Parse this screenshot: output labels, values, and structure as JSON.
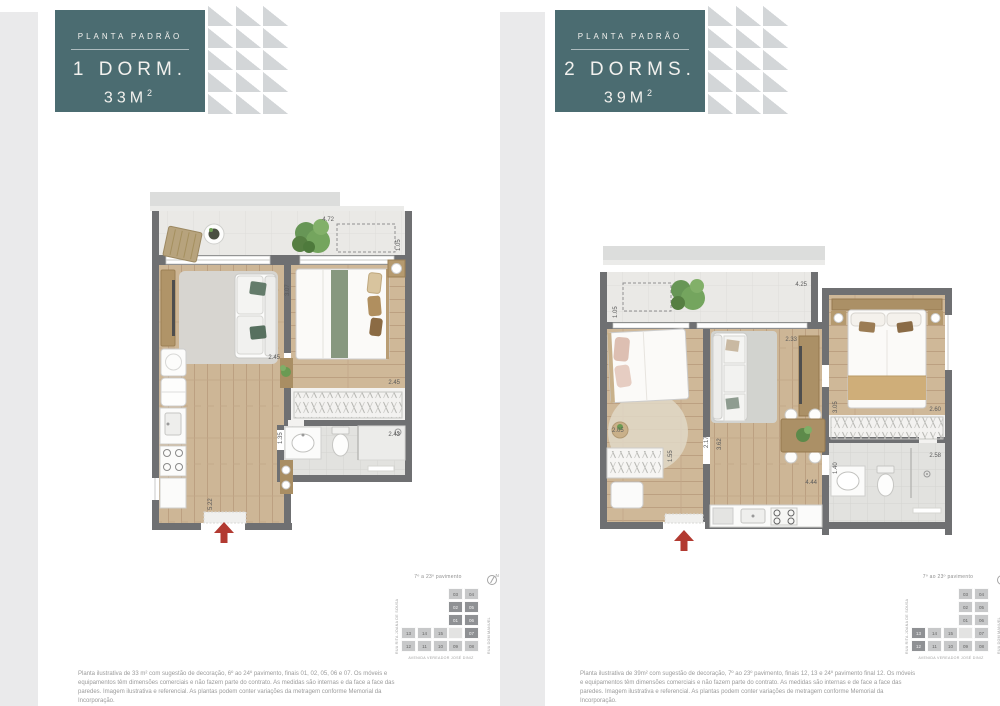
{
  "colors": {
    "accent_teal": "#4b6c71",
    "wall": "#6f7072",
    "entry_arrow": "#b23a31",
    "triangle": "#d3d6d8"
  },
  "panels": [
    {
      "badge": {
        "eyebrow": "PLANTA PADRÃO",
        "title": "1 DORM.",
        "area": "33M",
        "area_sup": "2"
      },
      "plan": {
        "dims": {
          "balcony_width": "4.72",
          "balcony_depth": "1.05",
          "bedroom_depth": "3.07",
          "living_width": "2.45",
          "closet_width": "2.45",
          "hall_width": "1.35",
          "bath_width": "2.43",
          "living_depth": "5.22"
        }
      },
      "keyplan": {
        "floors_label": "7º a 23º pavimento",
        "compass_n": "N",
        "street_left": "RUA RITA JOANA DE SOUSA",
        "street_right": "RUA DOM MANUEL",
        "street_bottom": "AVENIDA VEREADOR JOSÉ DINIZ",
        "highlighted": [
          "01",
          "02",
          "05",
          "06",
          "07"
        ],
        "units": [
          {
            "n": "03",
            "x": 47,
            "y": 0
          },
          {
            "n": "04",
            "x": 63,
            "y": 0
          },
          {
            "n": "02",
            "x": 47,
            "y": 13
          },
          {
            "n": "05",
            "x": 63,
            "y": 13
          },
          {
            "n": "01",
            "x": 47,
            "y": 26
          },
          {
            "n": "06",
            "x": 63,
            "y": 26
          },
          {
            "n": "",
            "x": 47,
            "y": 39
          },
          {
            "n": "07",
            "x": 63,
            "y": 39
          },
          {
            "n": "09",
            "x": 47,
            "y": 52
          },
          {
            "n": "08",
            "x": 63,
            "y": 52
          },
          {
            "n": "13",
            "x": 0,
            "y": 39
          },
          {
            "n": "14",
            "x": 16,
            "y": 39
          },
          {
            "n": "15",
            "x": 32,
            "y": 39
          },
          {
            "n": "12",
            "x": 0,
            "y": 52
          },
          {
            "n": "11",
            "x": 16,
            "y": 52
          },
          {
            "n": "10",
            "x": 32,
            "y": 52
          }
        ]
      },
      "caption": "Planta ilustrativa de 33 m² com sugestão de decoração, 6º ao 24º pavimento, finais 01, 02, 05, 06 e 07. Os móveis e equipamentos têm dimensões comerciais e não fazem parte do contrato. As medidas são internas e da face a face das paredes. Imagem ilustrativa e referencial. As plantas podem conter variações da metragem conforme Memorial da Incorporação."
    },
    {
      "badge": {
        "eyebrow": "PLANTA PADRÃO",
        "title": "2 DORMS.",
        "area": "39M",
        "area_sup": "2"
      },
      "plan": {
        "dims": {
          "balcony_width": "4.25",
          "balcony_depth": "1.05",
          "tv_wall_width": "2.33",
          "bedroom2_depth": "3.05",
          "bedroom2_width": "2.60",
          "closet_width": "2.05",
          "hall_depth": "1.55",
          "bedroom1_width": "2.17",
          "living_depth": "3.62",
          "bath_depth": "1.40",
          "bath_width": "2.58",
          "kitchen_width": "4.44"
        }
      },
      "keyplan": {
        "floors_label": "7º ao 23º pavimento",
        "compass_n": "N",
        "street_left": "RUA RITA JOANA DE SOUSA",
        "street_right": "RUA DOM MANUEL",
        "street_bottom": "AVENIDA VEREADOR JOSÉ DINIZ",
        "highlighted": [
          "12",
          "13"
        ],
        "units": [
          {
            "n": "03",
            "x": 47,
            "y": 0
          },
          {
            "n": "04",
            "x": 63,
            "y": 0
          },
          {
            "n": "02",
            "x": 47,
            "y": 13
          },
          {
            "n": "05",
            "x": 63,
            "y": 13
          },
          {
            "n": "01",
            "x": 47,
            "y": 26
          },
          {
            "n": "06",
            "x": 63,
            "y": 26
          },
          {
            "n": "",
            "x": 47,
            "y": 39
          },
          {
            "n": "07",
            "x": 63,
            "y": 39
          },
          {
            "n": "09",
            "x": 47,
            "y": 52
          },
          {
            "n": "08",
            "x": 63,
            "y": 52
          },
          {
            "n": "13",
            "x": 0,
            "y": 39
          },
          {
            "n": "14",
            "x": 16,
            "y": 39
          },
          {
            "n": "15",
            "x": 32,
            "y": 39
          },
          {
            "n": "12",
            "x": 0,
            "y": 52
          },
          {
            "n": "11",
            "x": 16,
            "y": 52
          },
          {
            "n": "10",
            "x": 32,
            "y": 52
          }
        ]
      },
      "caption": "Planta ilustrativa de 39m² com sugestão de decoração, 7º ao 23º pavimento, finais 12, 13 e 24º pavimento final 12. Os móveis e equipamentos têm dimensões comerciais e não fazem parte do contrato. As medidas são internas e de face a face das paredes. Imagem ilustrativa e referencial. As plantas podem conter variações de metragem conforme Memorial da Incorporação."
    }
  ]
}
